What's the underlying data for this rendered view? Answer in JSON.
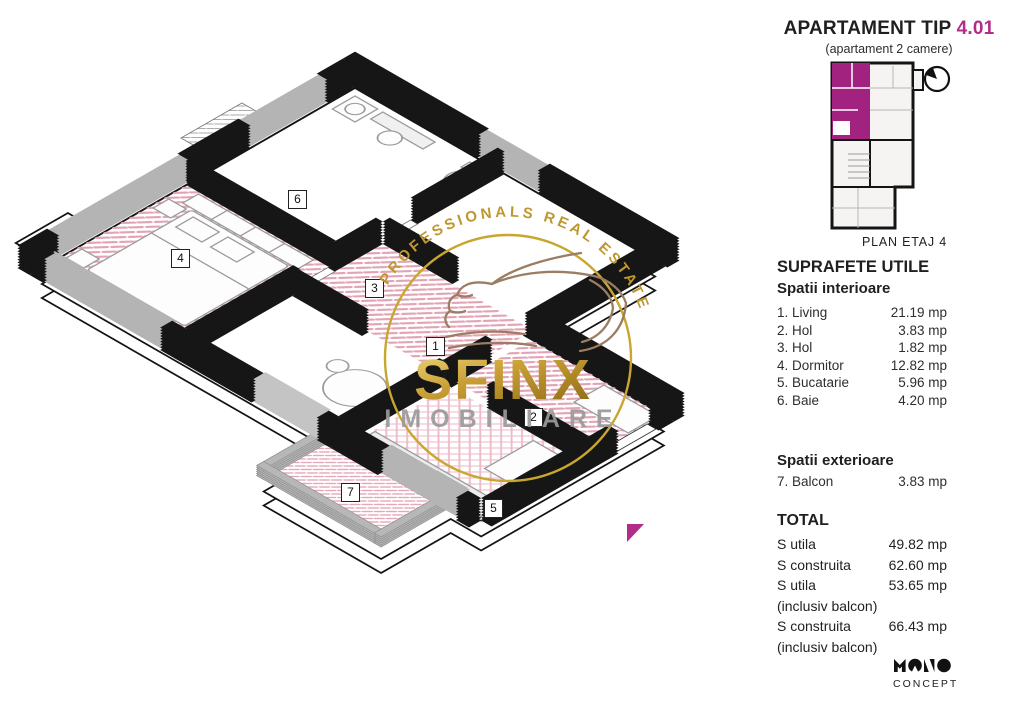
{
  "header": {
    "title": "APARTAMENT TIP",
    "unit_number": "4.01",
    "subtitle": "(apartament 2 camere)",
    "accent_color": "#B12D89"
  },
  "minimap": {
    "caption": "PLAN ETAJ 4",
    "highlight_color": "#A1237F"
  },
  "plan": {
    "room_labels": [
      "1",
      "2",
      "3",
      "4",
      "5",
      "6",
      "7"
    ],
    "entrance_marker_color": "#B12D89"
  },
  "watermark": {
    "arc_text": "PROFESSIONALS REAL ESTATE",
    "brand": "SFINX",
    "brand_sub": "IMOBILIARE",
    "gold_color": "#C9A62F"
  },
  "surfaces": {
    "title": "SUPRAFETE UTILE",
    "interior_title": "Spatii interioare",
    "interior_rows": [
      {
        "label": "1. Living",
        "value": "21.19 mp"
      },
      {
        "label": "2. Hol",
        "value": "3.83 mp"
      },
      {
        "label": "3. Hol",
        "value": "1.82 mp"
      },
      {
        "label": "4. Dormitor",
        "value": "12.82 mp"
      },
      {
        "label": "5. Bucatarie",
        "value": "5.96 mp"
      },
      {
        "label": "6. Baie",
        "value": "4.20 mp"
      }
    ],
    "exterior_title": "Spatii exterioare",
    "exterior_rows": [
      {
        "label": "7. Balcon",
        "value": "3.83 mp"
      }
    ],
    "total_title": "TOTAL",
    "total_rows": [
      {
        "label": "S utila",
        "note": "",
        "value": "49.82 mp"
      },
      {
        "label": "S construita",
        "note": "",
        "value": "62.60 mp"
      },
      {
        "label": "S utila",
        "note": "(inclusiv balcon)",
        "value": "53.65 mp"
      },
      {
        "label": "S construita",
        "note": "(inclusiv balcon)",
        "value": "66.43 mp"
      }
    ]
  },
  "branding": {
    "logo_sub": "CONCEPT"
  }
}
